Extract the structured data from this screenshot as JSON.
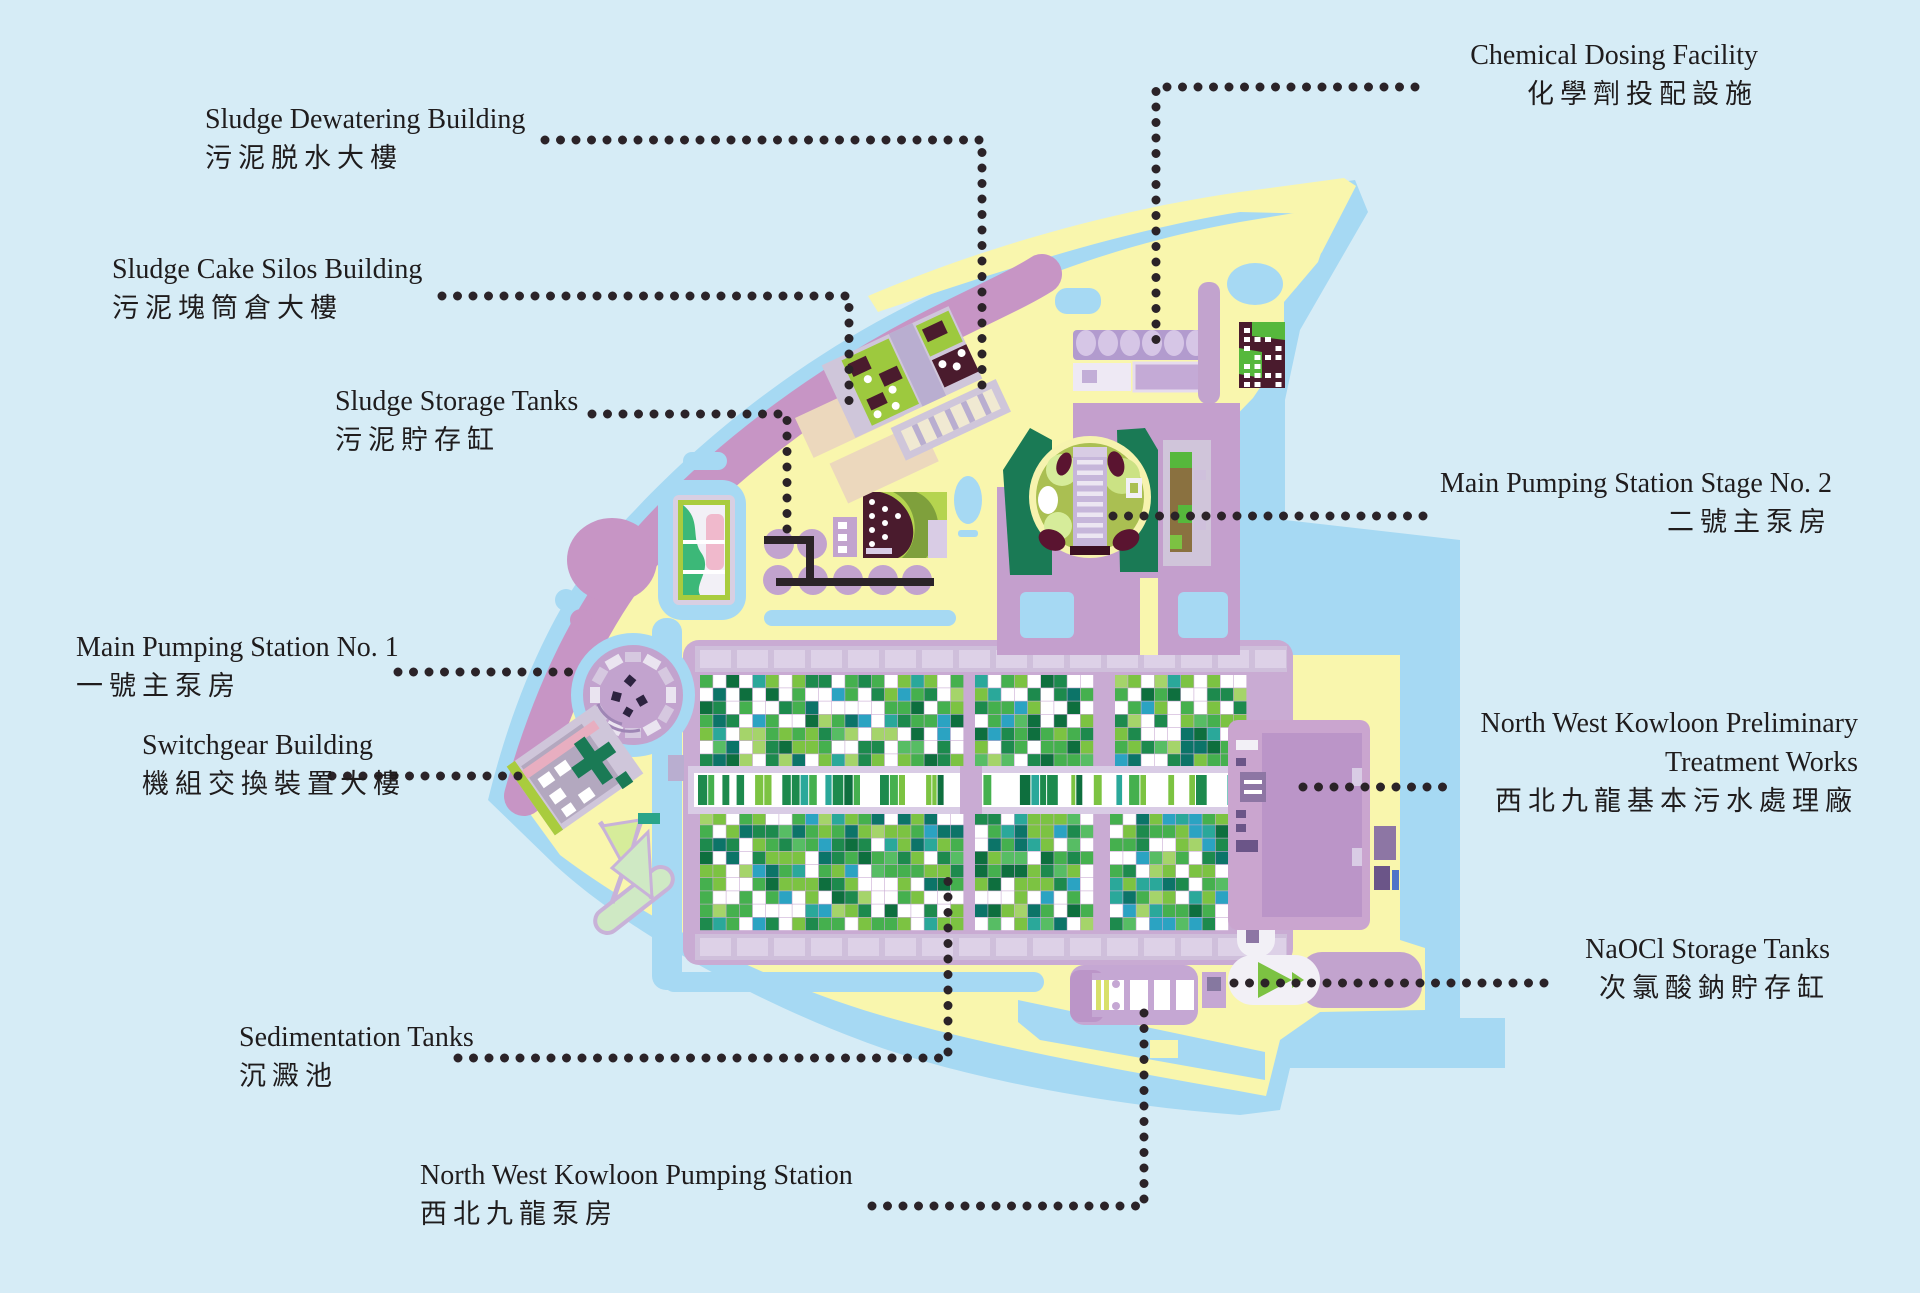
{
  "figure": {
    "type": "facility-site-map",
    "description": "Illustrated site plan of the North West Kowloon sewage treatment works with bilingual labels connected by dotted leader lines"
  },
  "labels": {
    "chemical_dosing": {
      "en": "Chemical Dosing Facility",
      "zh": "化學劑投配設施"
    },
    "sludge_dewatering": {
      "en": "Sludge Dewatering Building",
      "zh": "污泥脱水大樓"
    },
    "sludge_cake_silos": {
      "en": "Sludge Cake Silos Building",
      "zh": "污泥塊筒倉大樓"
    },
    "sludge_storage": {
      "en": "Sludge Storage Tanks",
      "zh": "污泥貯存缸"
    },
    "mps2": {
      "en": "Main Pumping Station Stage No. 2",
      "zh": "二號主泵房"
    },
    "mps1": {
      "en": "Main Pumping Station No. 1",
      "zh": "一號主泵房"
    },
    "ptw": {
      "en1": "North West Kowloon Preliminary",
      "en2": "Treatment Works",
      "zh": "西北九龍基本污水處理廠"
    },
    "switchgear": {
      "en": "Switchgear Building",
      "zh": "機組交換裝置大樓"
    },
    "naocl": {
      "en": "NaOCl Storage Tanks",
      "zh": "次氯酸鈉貯存缸"
    },
    "sedimentation": {
      "en": "Sedimentation Tanks",
      "zh": "沉澱池"
    },
    "nwkps": {
      "en": "North West Kowloon Pumping Station",
      "zh": "西北九龍泵房"
    }
  },
  "colors": {
    "background": "#d6ecf6",
    "water_band": "#a6d9f3",
    "land": "#f9f6ad",
    "coast_band": "#c795c5",
    "platform": "#c9abd3",
    "building_lavender": "#c2a3ce",
    "building_purple": "#bb95c8",
    "dark_maroon": "#4a1b2d",
    "dark_green": "#1a7a55",
    "leader_dots": "#2b2328",
    "text": "#1f1c1d",
    "tiles": [
      "#ffffff",
      "#45b04e",
      "#7cc342",
      "#1d8a4d",
      "#2aa89a",
      "#2ba3c2",
      "#0e6f3e",
      "#57bd64",
      "#0c7468",
      "#a5d46a"
    ],
    "stripes": [
      "#ffffff",
      "#45b04e",
      "#1d8a4d",
      "#2aa89a",
      "#0e6f3e",
      "#ffffff",
      "#7cc342",
      "#ffffff"
    ]
  }
}
